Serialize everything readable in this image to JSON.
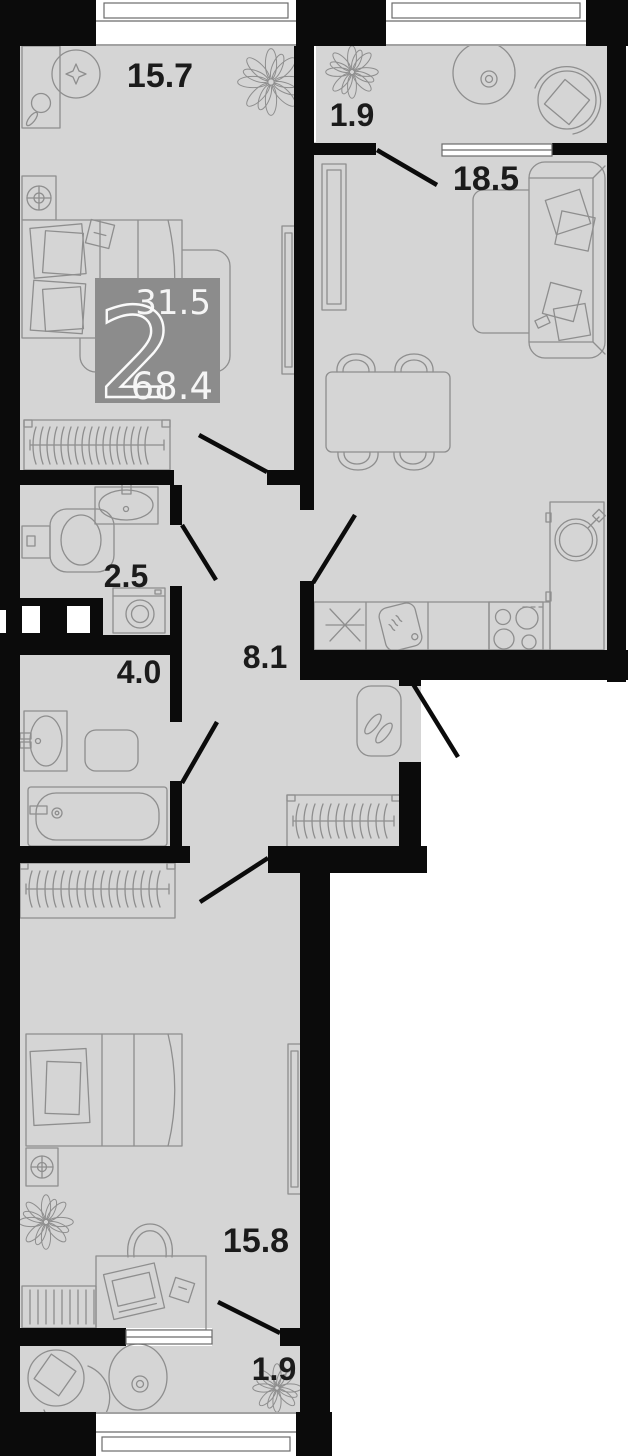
{
  "floorplan": {
    "type": "apartment-floor-plan",
    "badge": {
      "room_count": "2",
      "living_area": "31.5",
      "total_area": "68.4"
    },
    "rooms": [
      {
        "key": "bedroom-top",
        "label": "15.7"
      },
      {
        "key": "balcony-top",
        "label": "1.9"
      },
      {
        "key": "kitchen-living",
        "label": "18.5"
      },
      {
        "key": "bathroom-small",
        "label": "2.5"
      },
      {
        "key": "bathroom-large",
        "label": "4.0"
      },
      {
        "key": "hallway",
        "label": "8.1"
      },
      {
        "key": "bedroom-bottom",
        "label": "15.8"
      },
      {
        "key": "balcony-bottom",
        "label": "1.9"
      }
    ],
    "colors": {
      "floor": "#d5d5d5",
      "walls": "#0b0b0b",
      "badge_background": "#8c8c8c",
      "badge_text": "#f5f5f5",
      "furniture_stroke": "#8e8e8e",
      "label_text": "#1b1b1b",
      "outside": "#ffffff"
    }
  }
}
